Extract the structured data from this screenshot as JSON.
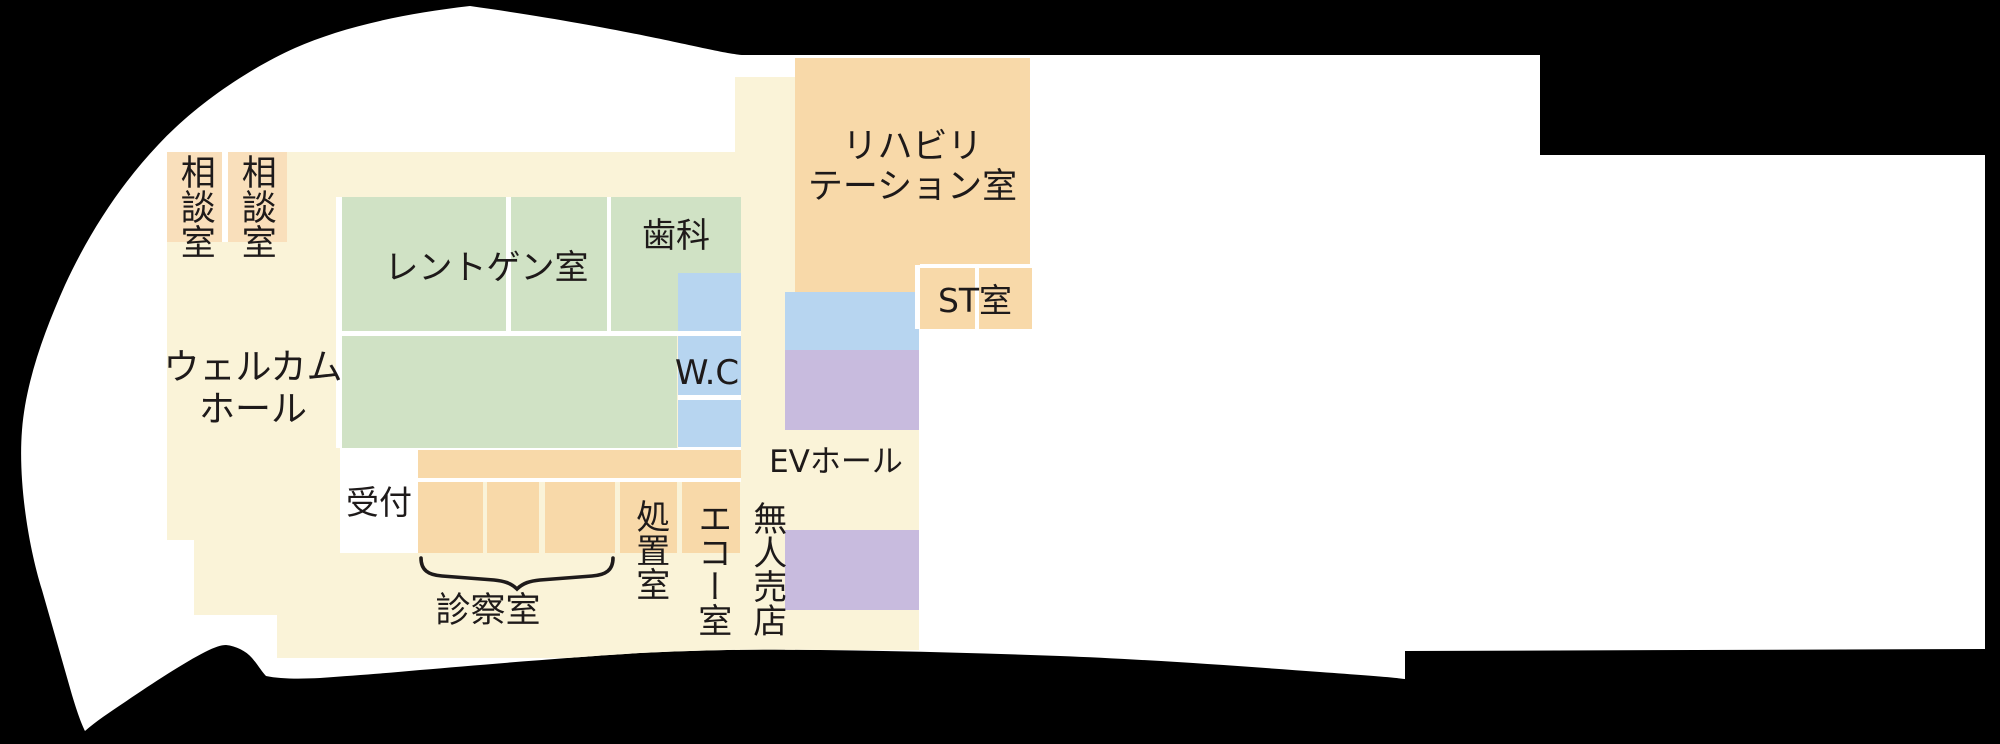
{
  "floor_plan": {
    "rooms": {
      "consult_1": "相談室",
      "consult_2": "相談室",
      "welcome_hall": "ウェルカム\nホール",
      "xray": "レントゲン室",
      "dental": "歯科",
      "rehab": "リハビリ\nテーション室",
      "st": "ST室",
      "wc": "W.C",
      "ev_hall": "EVホール",
      "reception": "受付",
      "exam": "診察室",
      "treatment": "処置室",
      "echo": "エコー室",
      "unmanned_shop": "無人売店"
    },
    "colors": {
      "background": "#000000",
      "floor_base": "#faf3d8",
      "room_green": "#d0e2c5",
      "room_orange": "#f8d9a9",
      "room_orange_light": "#f9dfbb",
      "room_blue": "#b7d5f0",
      "room_purple": "#c8bbde",
      "outline_white": "#ffffff",
      "text": "#1e1a1a"
    }
  }
}
